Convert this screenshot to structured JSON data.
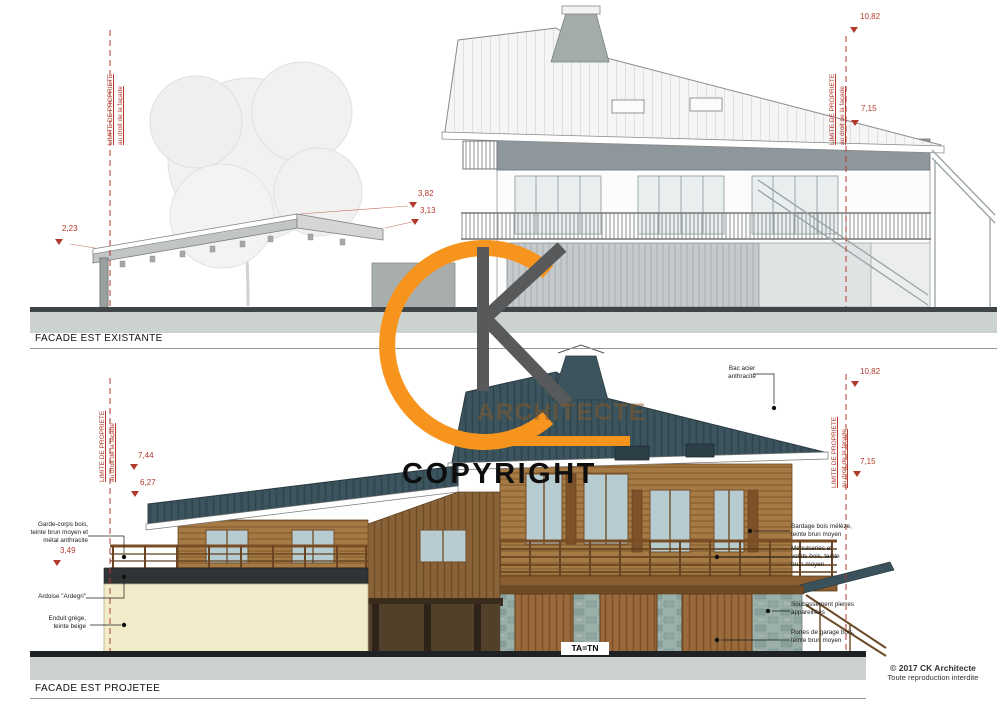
{
  "watermark": {
    "brand_text": "ARCHITECTE",
    "copyright_text": "COPYRIGHT"
  },
  "footer": {
    "copyright": "© 2017 CK Architecte",
    "notice": "Toute reproduction interdite"
  },
  "facade_existante": {
    "title": "FACADE EST EXISTANTE",
    "limit_left": {
      "line1": "LIMITE DE PROPRIETE",
      "line2": "au droit de la façade"
    },
    "limit_right": {
      "line1": "LIMITE DE PROPRIETE",
      "line2": "au droit de la façade"
    },
    "dims": {
      "right_top": "10,82",
      "right_mid": "7,15",
      "left": "2,23",
      "mid_top": "3,82",
      "mid_low": "3,13"
    }
  },
  "facade_projetee": {
    "title": "FACADE EST PROJETEE",
    "limit_left": {
      "line1": "LIMITE DE PROPRIETE",
      "line2": "au droit de la façade"
    },
    "limit_right": {
      "line1": "LIMITE DE PROPRIETE",
      "line2": "au droit de la façade"
    },
    "dims": {
      "left_top": "7,44",
      "left_mid": "6,27",
      "left_low": "3,49",
      "right_top": "10,82",
      "right_mid": "7,15"
    },
    "ground_label": "TA=TN",
    "labels_left": [
      "Garde-corps bois, teinte brun moyen et métal anthracite",
      "Ardoise \"Ardegri\"",
      "Enduit grège, teinte beige"
    ],
    "labels_right": [
      "Bac acier anthracite",
      "Bardage bois mélèze, teinte brun moyen",
      "Menuiseries et volets bois, teinte brun moyen",
      "Soubassement pierres appareillées",
      "Portes de garage bois, teinte brun moyen"
    ]
  },
  "colors": {
    "annotation_red": "#b23a2c",
    "roof_anthracite": "#3b545e",
    "wood_brown": "#a57a45",
    "wall_beige": "#f3ecca",
    "stone_gray": "#9cb0aa",
    "watermark_orange": "#f7941d",
    "watermark_gray": "#58595b",
    "ground_band": "#ccd3cf"
  }
}
